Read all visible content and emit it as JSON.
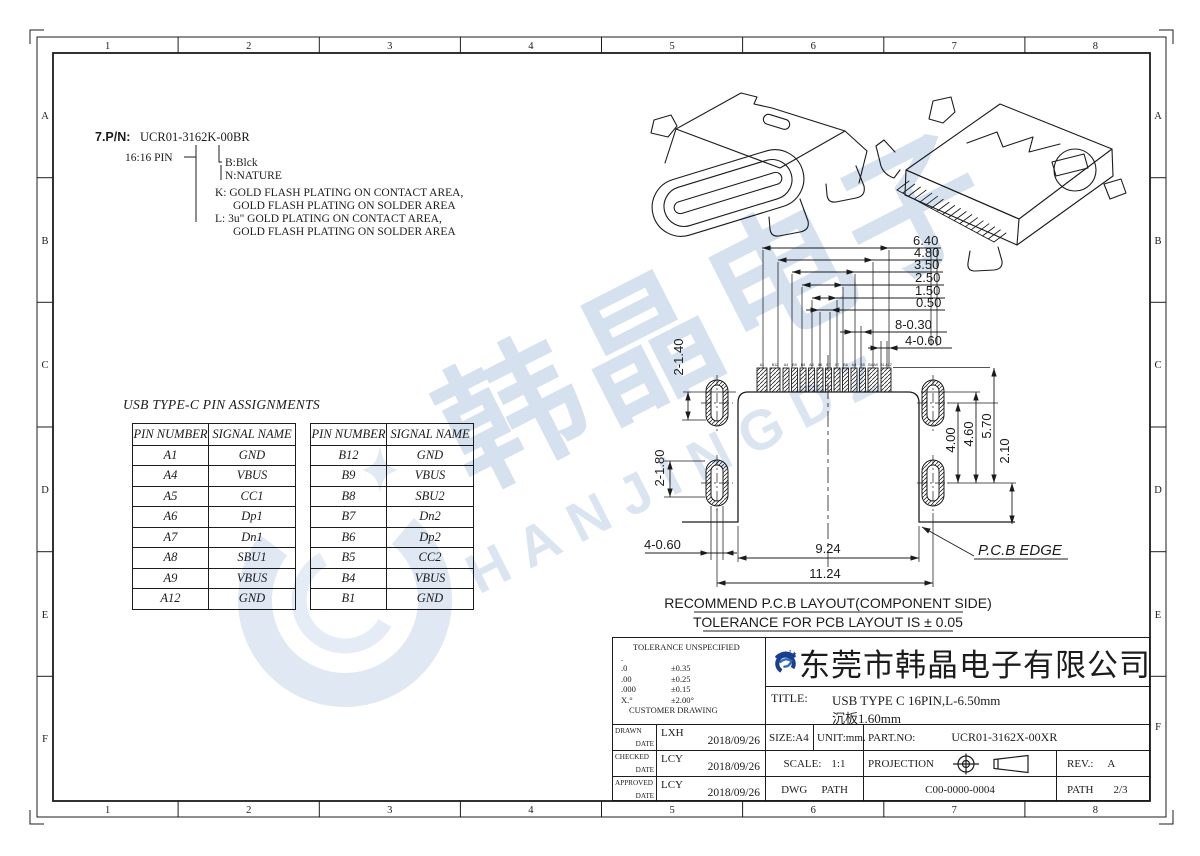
{
  "frame": {
    "cols": [
      "1",
      "2",
      "3",
      "4",
      "5",
      "6",
      "7",
      "8"
    ],
    "rows": [
      "A",
      "B",
      "C",
      "D",
      "E",
      "F"
    ]
  },
  "callout": {
    "prefix": "7.P/N:",
    "part": "UCR01-3162K-00BR",
    "pin_note": "16:16 PIN",
    "b_note": "B:Blck",
    "n_note": "N:NATURE",
    "k_note1": "K: GOLD FLASH PLATING ON CONTACT AREA,",
    "k_note2": "GOLD FLASH PLATING ON SOLDER AREA",
    "l_note1": "L: 3u\" GOLD PLATING ON CONTACT AREA,",
    "l_note2": "GOLD FLASH PLATING ON SOLDER AREA"
  },
  "pin_table": {
    "title": "USB TYPE-C PIN ASSIGNMENTS",
    "headers": [
      "PIN NUMBER",
      "SIGNAL NAME"
    ],
    "left": [
      [
        "A1",
        "GND"
      ],
      [
        "A4",
        "VBUS"
      ],
      [
        "A5",
        "CC1"
      ],
      [
        "A6",
        "Dp1"
      ],
      [
        "A7",
        "Dn1"
      ],
      [
        "A8",
        "SBU1"
      ],
      [
        "A9",
        "VBUS"
      ],
      [
        "A12",
        "GND"
      ]
    ],
    "right": [
      [
        "B12",
        "GND"
      ],
      [
        "B9",
        "VBUS"
      ],
      [
        "B8",
        "SBU2"
      ],
      [
        "B7",
        "Dn2"
      ],
      [
        "B6",
        "Dp2"
      ],
      [
        "B5",
        "CC2"
      ],
      [
        "B4",
        "VBUS"
      ],
      [
        "B1",
        "GND"
      ]
    ]
  },
  "dims": {
    "stack": [
      "6.40",
      "4.80",
      "3.50",
      "2.50",
      "1.50",
      "0.50",
      "8-0.30",
      "4-0.60"
    ],
    "left": [
      "2-1.40",
      "2-1.80"
    ],
    "right": [
      "4.00",
      "4.60",
      "5.70",
      "2.10"
    ],
    "bottom": [
      "9.24",
      "11.24"
    ],
    "holes_bl": "4-0.60",
    "pcb_edge": "P.C.B EDGE"
  },
  "pad_labels": [
    "A1",
    "B12",
    "A4",
    "B9",
    "B8",
    "A5",
    "A6",
    "B7",
    "A7",
    "B6",
    "A8",
    "B5",
    "B4 A9",
    "B1 A12"
  ],
  "notes": {
    "line1": "RECOMMEND P.C.B LAYOUT(COMPONENT SIDE)",
    "line2": "TOLERANCE FOR PCB LAYOUT IS ± 0.05"
  },
  "watermark": {
    "cn": "韩晶电子",
    "en": "HANJINGDZ"
  },
  "title_block": {
    "tolerance": {
      "title": "TOLERANCE UNSPECIFIED",
      "dot": ".",
      "rows": [
        [
          ".0",
          "±0.35"
        ],
        [
          ".00",
          "±0.25"
        ],
        [
          ".000",
          "±0.15"
        ],
        [
          "X.°",
          "±2.00°"
        ]
      ],
      "footer": "CUSTOMER DRAWING"
    },
    "company": "东莞市韩晶电子有限公司",
    "title_label": "TITLE:",
    "title_line1": "USB TYPE C 16PIN,L-6.50mm",
    "title_line2": "沉板1.60mm",
    "size": "SIZE:A4",
    "unit": "UNIT:mm.",
    "part_label": "PART.NO:",
    "part_no": "UCR01-3162X-00XR",
    "drawn_label": "DRAWN",
    "checked_label": "CHECKED",
    "approved_label": "APPROVED",
    "date_label": "DATE",
    "drawn_name": "LXH",
    "drawn_date": "2018/09/26",
    "checked_name": "LCY",
    "checked_date": "2018/09/26",
    "approved_name": "LCY",
    "approved_date": "2018/09/26",
    "scale_label": "SCALE:",
    "scale_value": "1:1",
    "projection_label": "PROJECTION",
    "rev_label": "REV.:",
    "rev_value": "A",
    "dwg_label": "DWG",
    "path_label": "PATH",
    "dwg_no": "C00-0000-0004",
    "path_value": "2/3"
  }
}
